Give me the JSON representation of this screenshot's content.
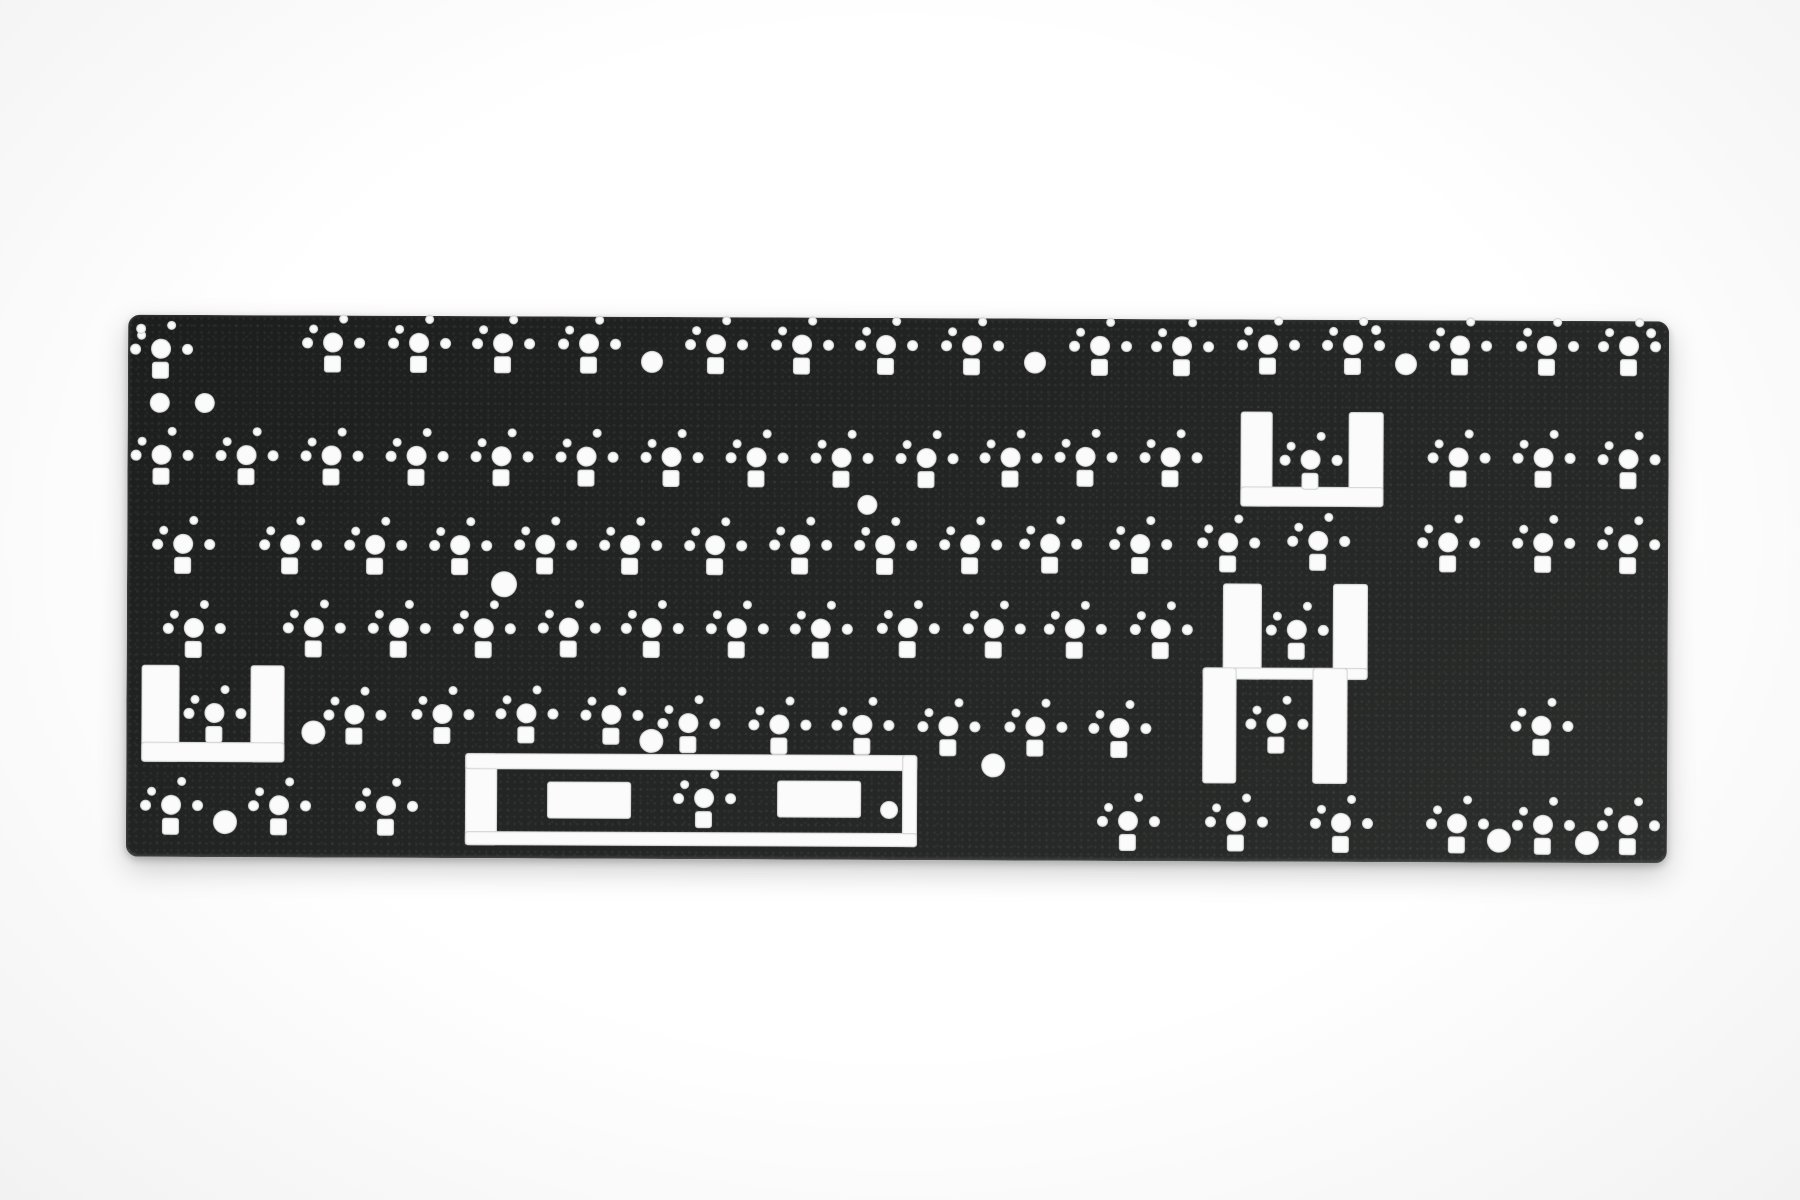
{
  "photo": {
    "background_color": "#f7f7f7",
    "cutout_color": "#fbfbfb",
    "plate": {
      "x": 127,
      "y": 318,
      "width": 1541,
      "height": 542,
      "corner_radius": 12,
      "color": "#232525"
    },
    "cluster_template": {
      "main": {
        "dx": -10,
        "dy": -10,
        "w": 20,
        "h": 20,
        "shape": "circle"
      },
      "left_pin": {
        "dx": -31,
        "dy": -5,
        "w": 11,
        "h": 11,
        "shape": "circle"
      },
      "right_pin": {
        "dx": 21,
        "dy": -5,
        "w": 11,
        "h": 11,
        "shape": "circle"
      },
      "upleft_pin": {
        "dx": -24,
        "dy": -18,
        "w": 9,
        "h": 9,
        "shape": "circle"
      },
      "top_pin": {
        "dx": 6,
        "dy": -28,
        "w": 9,
        "h": 9,
        "shape": "circle"
      },
      "led_square": {
        "dx": -9,
        "dy": 13,
        "w": 17,
        "h": 17,
        "shape": "square"
      }
    },
    "switch_clusters": [
      [
        160,
        352
      ],
      [
        332,
        345
      ],
      [
        418,
        345
      ],
      [
        502,
        345
      ],
      [
        588,
        345
      ],
      [
        715,
        345
      ],
      [
        801,
        345
      ],
      [
        885,
        345
      ],
      [
        971,
        345
      ],
      [
        1099,
        345
      ],
      [
        1181,
        345
      ],
      [
        1267,
        343
      ],
      [
        1352,
        343
      ],
      [
        1459,
        343
      ],
      [
        1546,
        343
      ],
      [
        1628,
        343
      ],
      [
        161,
        458
      ],
      [
        246,
        458
      ],
      [
        331,
        458
      ],
      [
        416,
        458
      ],
      [
        501,
        458
      ],
      [
        586,
        458
      ],
      [
        671,
        458
      ],
      [
        756,
        458
      ],
      [
        841,
        458
      ],
      [
        926,
        458
      ],
      [
        1010,
        457
      ],
      [
        1085,
        456
      ],
      [
        1170,
        456
      ],
      [
        1310,
        458
      ],
      [
        1458,
        455
      ],
      [
        1543,
        455
      ],
      [
        1628,
        456
      ],
      [
        183,
        547
      ],
      [
        290,
        547
      ],
      [
        375,
        547
      ],
      [
        460,
        547
      ],
      [
        545,
        546
      ],
      [
        630,
        546
      ],
      [
        715,
        546
      ],
      [
        800,
        545
      ],
      [
        885,
        545
      ],
      [
        970,
        544
      ],
      [
        1050,
        543
      ],
      [
        1140,
        543
      ],
      [
        1228,
        541
      ],
      [
        1318,
        539
      ],
      [
        1448,
        540
      ],
      [
        1543,
        540
      ],
      [
        1628,
        541
      ],
      [
        194,
        631
      ],
      [
        314,
        630
      ],
      [
        399,
        630
      ],
      [
        484,
        630
      ],
      [
        569,
        629
      ],
      [
        652,
        629
      ],
      [
        737,
        629
      ],
      [
        821,
        629
      ],
      [
        908,
        628
      ],
      [
        994,
        628
      ],
      [
        1075,
        628
      ],
      [
        1161,
        628
      ],
      [
        1297,
        628
      ],
      [
        215,
        716
      ],
      [
        355,
        717
      ],
      [
        443,
        716
      ],
      [
        527,
        715
      ],
      [
        612,
        716
      ],
      [
        689,
        724
      ],
      [
        780,
        725
      ],
      [
        863,
        725
      ],
      [
        949,
        726
      ],
      [
        1036,
        726
      ],
      [
        1120,
        727
      ],
      [
        1277,
        722
      ],
      [
        1542,
        723
      ],
      [
        172,
        808
      ],
      [
        280,
        808
      ],
      [
        387,
        808
      ],
      [
        705,
        799
      ],
      [
        1129,
        820
      ],
      [
        1237,
        820
      ],
      [
        1342,
        821
      ],
      [
        1458,
        821
      ],
      [
        1544,
        822
      ],
      [
        1629,
        822
      ]
    ],
    "round_holes": [
      [
        651,
        363,
        11
      ],
      [
        1034,
        362,
        11
      ],
      [
        1405,
        362,
        11
      ],
      [
        159,
        406,
        10
      ],
      [
        204,
        406,
        10
      ],
      [
        867,
        505,
        10
      ],
      [
        504,
        586,
        13
      ],
      [
        314,
        735,
        12
      ],
      [
        652,
        742,
        12
      ],
      [
        994,
        765,
        12
      ],
      [
        226,
        825,
        12
      ],
      [
        890,
        810,
        9
      ],
      [
        1500,
        838,
        12
      ],
      [
        1588,
        840,
        12
      ],
      [
        1375,
        328,
        5
      ],
      [
        1650,
        330,
        5
      ],
      [
        140,
        332,
        5
      ]
    ],
    "stabilizer_cutouts": [
      [
        142,
        668,
        38,
        97
      ],
      [
        251,
        668,
        34,
        97
      ],
      [
        142,
        745,
        143,
        20
      ],
      [
        1240,
        410,
        32,
        95
      ],
      [
        1348,
        410,
        35,
        95
      ],
      [
        1240,
        485,
        143,
        20
      ],
      [
        1223,
        582,
        39,
        96
      ],
      [
        1333,
        582,
        35,
        96
      ],
      [
        1203,
        666,
        165,
        12
      ],
      [
        1203,
        666,
        34,
        116
      ],
      [
        1313,
        666,
        35,
        116
      ],
      [
        466,
        755,
        32,
        92
      ],
      [
        466,
        755,
        452,
        16
      ],
      [
        903,
        755,
        15,
        92
      ],
      [
        466,
        833,
        452,
        14
      ]
    ],
    "spacebar_island_rects": [
      [
        548,
        783,
        84,
        37
      ],
      [
        778,
        781,
        84,
        37
      ]
    ]
  }
}
